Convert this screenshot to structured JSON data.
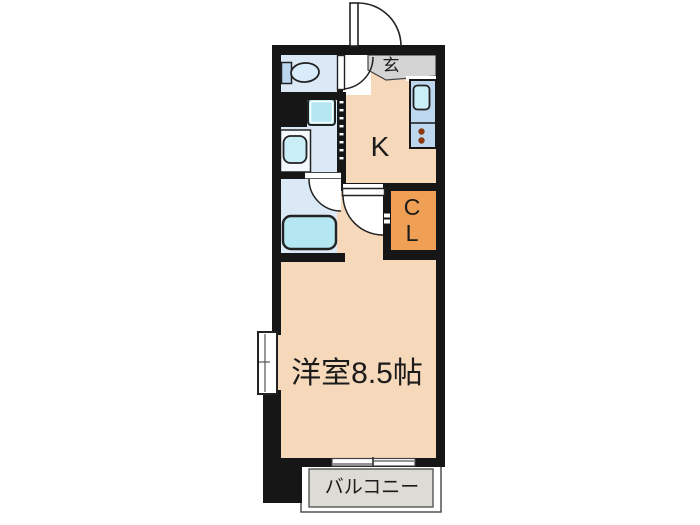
{
  "labels": {
    "entrance": "玄",
    "kitchen": "K",
    "closet_line1": "C",
    "closet_line2": "L",
    "main_room": "洋室8.5帖",
    "balcony": "バルコニー"
  },
  "colors": {
    "wall": "#161616",
    "room_peach": "#f6d8ba",
    "wet_room_blue": "#dbe9f6",
    "fixture_cyan": "#c9eef8",
    "fixture_cyan2": "#b4e7f1",
    "counter_blue": "#bdd7ee",
    "closet_orange": "#f0a055",
    "entrance_gray": "#d4d4d4",
    "balcony_gray": "#dedad5",
    "burner_brown": "#8a3c10"
  },
  "icons": [
    "toilet-icon",
    "washing-machine-icon",
    "vanity-sink-icon",
    "bathtub-icon",
    "kitchen-sink-icon",
    "stove-burners-icon",
    "door-swing-icon",
    "sliding-window-icon"
  ]
}
